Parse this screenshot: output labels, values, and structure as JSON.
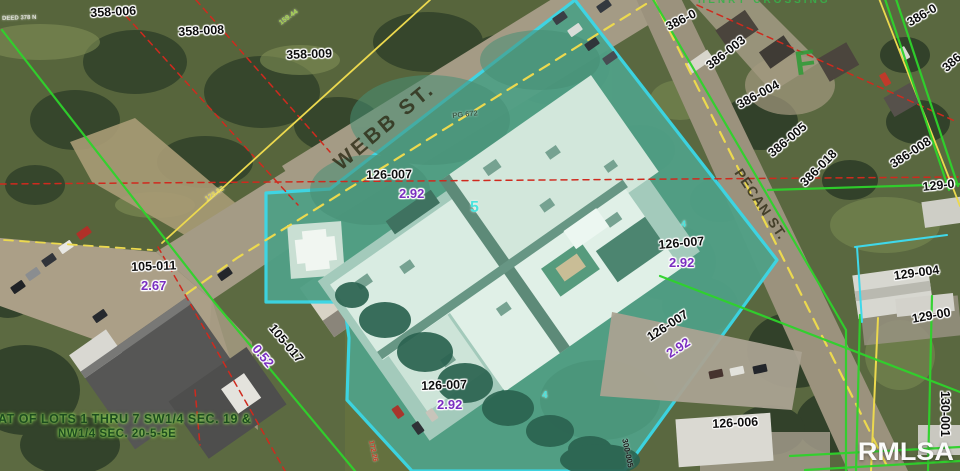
{
  "map_colors": {
    "highlight_fill": "#51a086",
    "highlight_border": "#3bd7e6",
    "boundary_green": "#2ed32b",
    "boundary_yellow": "#ecd94e",
    "boundary_red": "#cf2a1e",
    "parcel_text": "#0e0e0e",
    "parcel_value_purple": "#7a2fc0",
    "watermark_white": "#fafafa"
  },
  "street_labels": [
    {
      "text": "WEBB ST.",
      "x": 330,
      "y": 158,
      "rot": -40,
      "size": 21,
      "spacing": 3
    },
    {
      "text": "PECAN ST.",
      "x": 744,
      "y": 166,
      "rot": 56,
      "size": 14,
      "spacing": 1
    }
  ],
  "parcel_labels": [
    {
      "text": "358-006",
      "x": 90,
      "y": 7,
      "rot": -3
    },
    {
      "text": "358-008",
      "x": 178,
      "y": 26,
      "rot": -3
    },
    {
      "text": "358-009",
      "x": 286,
      "y": 49,
      "rot": -2
    },
    {
      "text": "126-007",
      "x": 366,
      "y": 169,
      "rot": -1
    },
    {
      "text": "105-011",
      "x": 131,
      "y": 261,
      "rot": -2
    },
    {
      "text": "105-017",
      "x": 276,
      "y": 322,
      "rot": 50
    },
    {
      "text": "126-007",
      "x": 658,
      "y": 239,
      "rot": -5
    },
    {
      "text": "126-007",
      "x": 645,
      "y": 333,
      "rot": -33
    },
    {
      "text": "126-007",
      "x": 421,
      "y": 380,
      "rot": -2
    },
    {
      "text": "126-006",
      "x": 712,
      "y": 418,
      "rot": -3
    },
    {
      "text": "386-0",
      "x": 664,
      "y": 22,
      "rot": -27
    },
    {
      "text": "386-003",
      "x": 704,
      "y": 62,
      "rot": -38
    },
    {
      "text": "386-004",
      "x": 735,
      "y": 100,
      "rot": -28
    },
    {
      "text": "386-005",
      "x": 766,
      "y": 150,
      "rot": -40
    },
    {
      "text": "386-018",
      "x": 798,
      "y": 180,
      "rot": -45
    },
    {
      "text": "386-008",
      "x": 888,
      "y": 160,
      "rot": -33
    },
    {
      "text": "386-0",
      "x": 905,
      "y": 18,
      "rot": -30
    },
    {
      "text": "386",
      "x": 940,
      "y": 65,
      "rot": -42
    },
    {
      "text": "129-0",
      "x": 922,
      "y": 181,
      "rot": -6
    },
    {
      "text": "129-004",
      "x": 893,
      "y": 270,
      "rot": -8
    },
    {
      "text": "129-00",
      "x": 911,
      "y": 313,
      "rot": -10
    },
    {
      "text": "130-001",
      "x": 951,
      "y": 391,
      "rot": 90
    }
  ],
  "value_labels": [
    {
      "text": "2.92",
      "x": 399,
      "y": 187,
      "rot": 0
    },
    {
      "text": "2.67",
      "x": 141,
      "y": 279,
      "rot": 0
    },
    {
      "text": "0.52",
      "x": 260,
      "y": 342,
      "rot": 50
    },
    {
      "text": "2.92",
      "x": 669,
      "y": 256,
      "rot": 0
    },
    {
      "text": "2.92",
      "x": 664,
      "y": 349,
      "rot": -33
    },
    {
      "text": "2.92",
      "x": 437,
      "y": 398,
      "rot": 0
    }
  ],
  "tiny_labels": [
    {
      "text": "DEED 378 N",
      "x": 2,
      "y": 16,
      "rot": -2,
      "size": 6,
      "color": "#dfe0d8"
    },
    {
      "text": "159.44",
      "x": 278,
      "y": 21,
      "rot": -36,
      "size": 7,
      "color": "#a8d84e"
    },
    {
      "text": "128.92",
      "x": 204,
      "y": 197,
      "rot": -33,
      "size": 7,
      "color": "#e6d64e"
    },
    {
      "text": "PG 672",
      "x": 452,
      "y": 112,
      "rot": -6,
      "size": 7.5,
      "color": "#3e5c48"
    },
    {
      "text": "172.26",
      "x": 374,
      "y": 440,
      "rot": 78,
      "size": 7,
      "color": "#cf3b28"
    },
    {
      "text": "300-005",
      "x": 628,
      "y": 438,
      "rot": 78,
      "size": 8,
      "color": "#1c1c1c"
    },
    {
      "text": "5",
      "x": 470,
      "y": 200,
      "rot": 0,
      "size": 16,
      "color": "#4ae4de"
    },
    {
      "text": "4",
      "x": 542,
      "y": 391,
      "rot": 0,
      "size": 10,
      "color": "#4ae4de"
    },
    {
      "text": "4",
      "x": 681,
      "y": 220,
      "rot": 0,
      "size": 9,
      "color": "#4ae4de"
    }
  ],
  "survey_note": {
    "line1": "AT OF LOTS 1 THRU 7 SW1/4 SEC. 19 &",
    "line2": "NW1/4 SEC. 20-5-5E"
  },
  "watermark": "RMLSA",
  "block_letter": "F",
  "top_street_partial": "HENRY CROSSING"
}
